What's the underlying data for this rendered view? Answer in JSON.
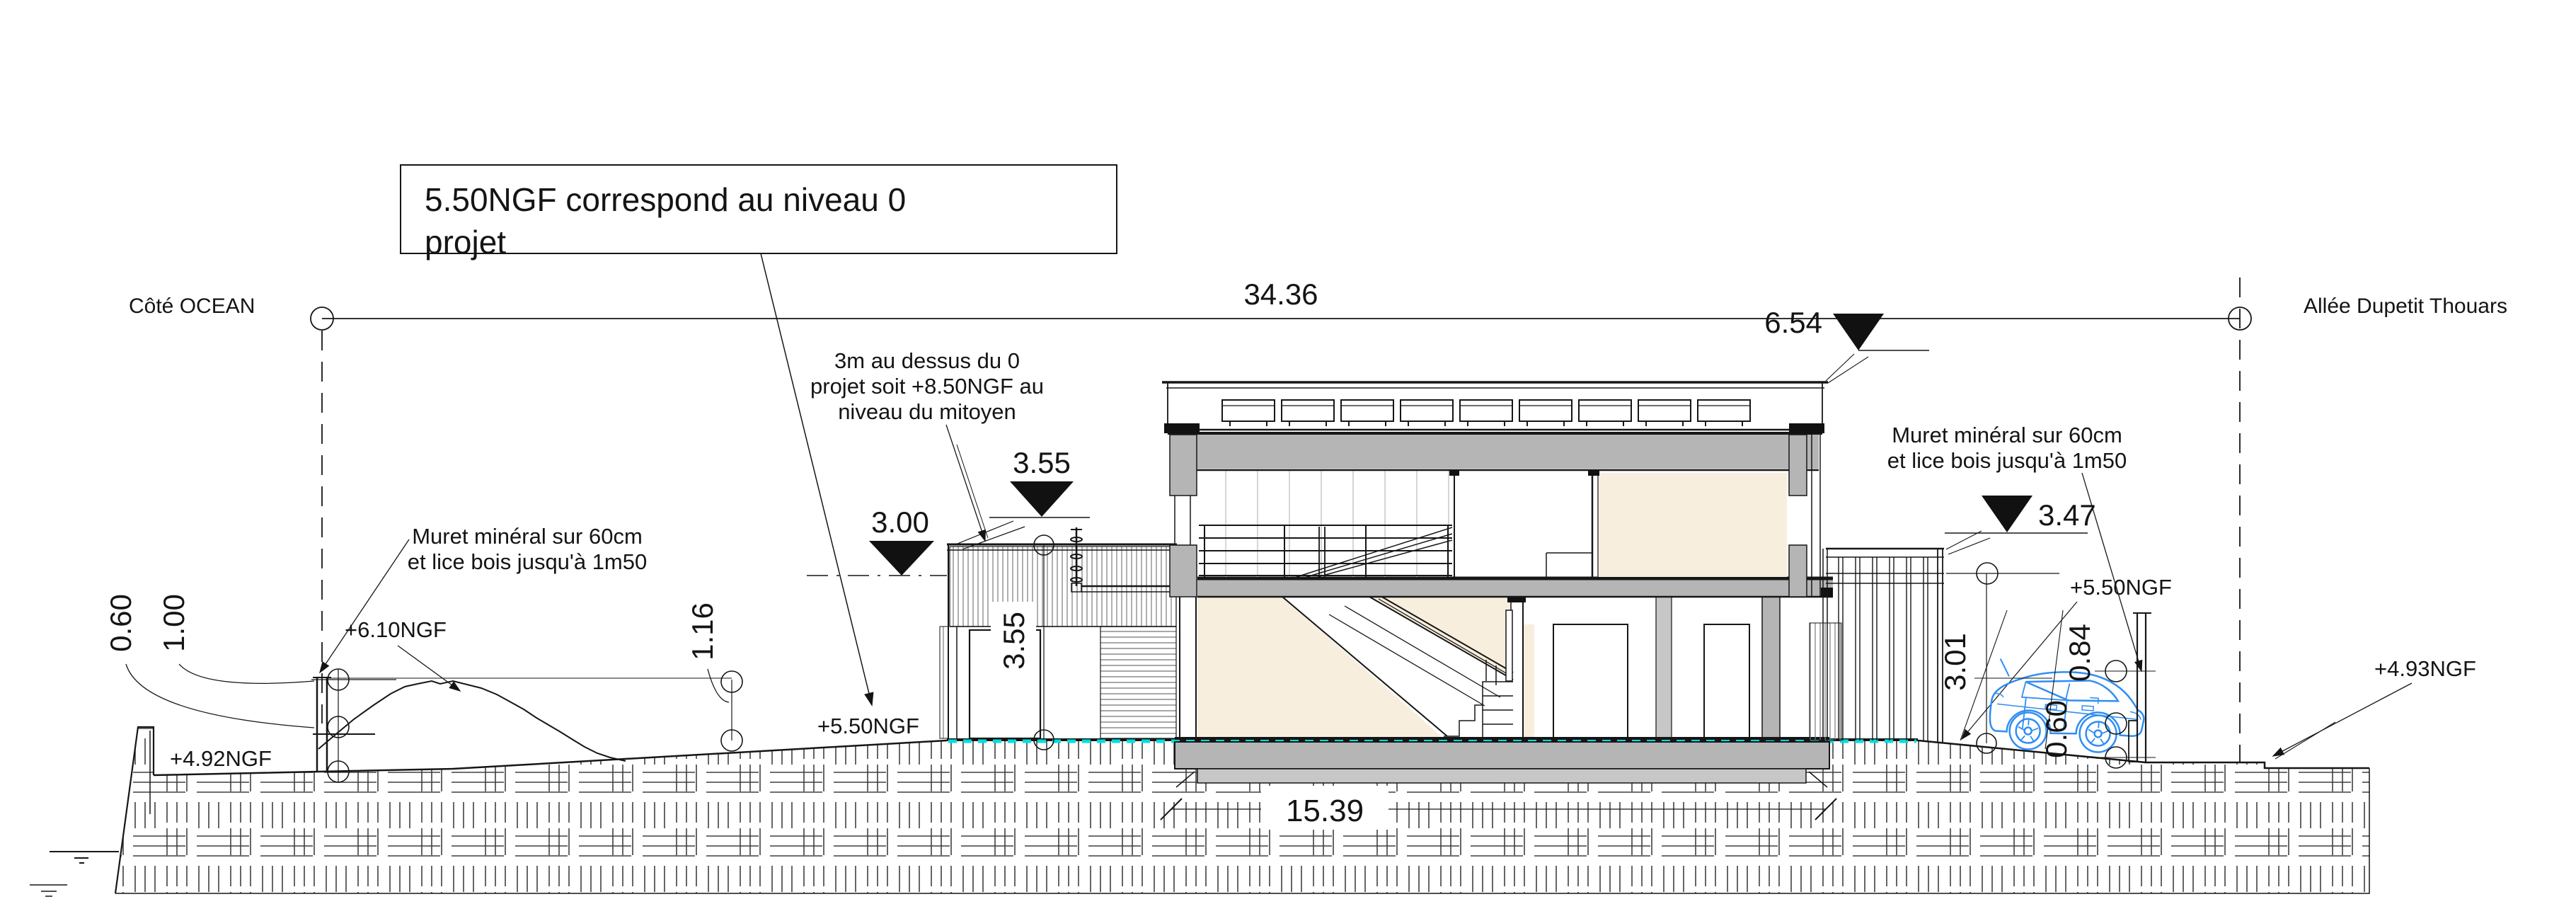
{
  "title_note": {
    "line1": "5.50NGF correspond au niveau 0",
    "line2": "projet"
  },
  "sides": {
    "left_label": "Côté OCEAN",
    "right_label": "Allée Dupetit Thouars"
  },
  "notes": {
    "mitoyen_line1": "3m au dessus du 0",
    "mitoyen_line2": "projet soit +8.50NGF au",
    "mitoyen_line3": "niveau du mitoyen",
    "muret_left_line1": "Muret minéral sur 60cm",
    "muret_left_line2": "et lice bois jusqu'à 1m50",
    "muret_right_line1": "Muret minéral sur 60cm",
    "muret_right_line2": "et lice bois jusqu'à 1m50"
  },
  "dimensions": {
    "total_width": "34.36",
    "building_height": "6.54",
    "annex_level": "3.55",
    "mitoyen_level": "3.00",
    "annex_height": "3.55",
    "fence_level": "3.47",
    "building_width": "15.39",
    "right_height": "3.01",
    "right_lice": "0.84",
    "right_muret": "0.60",
    "left_muret": "0.60",
    "left_lice": "1.00",
    "left_wall": "1.16"
  },
  "levels": {
    "ngf_610": "+6.10NGF",
    "ngf_492": "+4.92NGF",
    "ngf_550_left": "+5.50NGF",
    "ngf_550_right": "+5.50NGF",
    "ngf_493": "+4.93NGF"
  },
  "colors": {
    "slab_gray": "#b5b5b5",
    "foundation_gray": "#c7c7c7",
    "room_beige": "#f7eedd",
    "ground_marker_cyan": "#00dede",
    "car_blue": "#2f8ef2",
    "line_black": "#161616"
  }
}
